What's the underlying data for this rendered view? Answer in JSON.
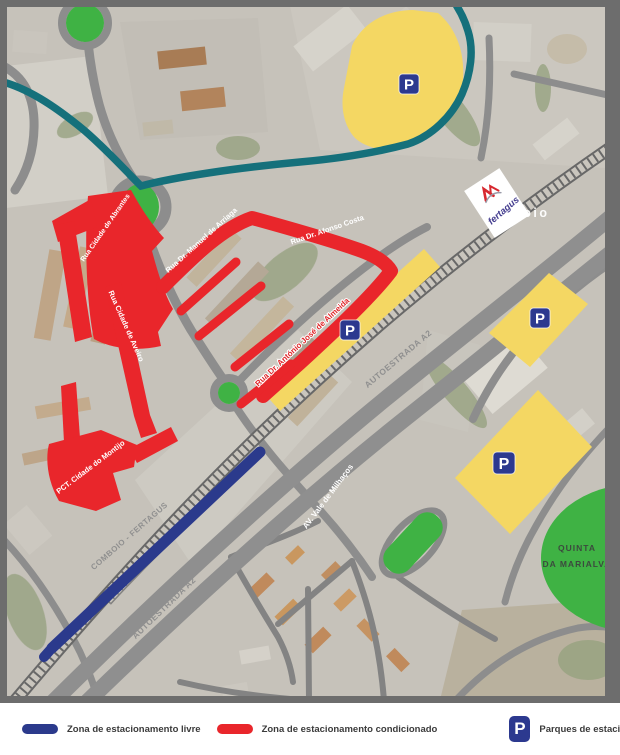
{
  "map": {
    "station_partial_label": "rroio",
    "operator_logo_text": "fertagus",
    "parking_marker_letter": "P",
    "street_labels": [
      {
        "text": "Rua Cidade de Abrantes"
      },
      {
        "text": "Rua Dr. Manuel de Arriaga"
      },
      {
        "text": "Rua Dr. Afonso Costa"
      },
      {
        "text": "Rua Cidade de Aveiro"
      },
      {
        "text": "Rua Dr. António José de Almeida"
      },
      {
        "text": "PCT. Cidade do Montijo"
      },
      {
        "text": "COMBOIO - FERTAGUS"
      },
      {
        "text": "AUTOESTRADA A2"
      },
      {
        "text": "AUTOESTRADA A2"
      },
      {
        "text": "AV. Vale de Milhaços"
      }
    ],
    "area_labels": [
      {
        "line1": "QUINTA",
        "line2": "DA MARIALVA"
      }
    ]
  },
  "legend": {
    "items": [
      {
        "label": "Zona de estacionamento livre",
        "swatch_color": "#2b3a8c"
      },
      {
        "label": "Zona de estacionamento condicionado",
        "swatch_color": "#e9262b"
      },
      {
        "label": "Parques de estacionamento da Fertagus",
        "symbol": "P",
        "swatch_color": "#2c398f"
      }
    ]
  },
  "colors": {
    "free_zone": "#2b3a8c",
    "restricted_zone": "#e9262b",
    "fertagus_parking_area": "#f4d763",
    "parking_sign": "#2c398f",
    "highlight_route": "#15707b",
    "green_space": "#3fb244"
  }
}
